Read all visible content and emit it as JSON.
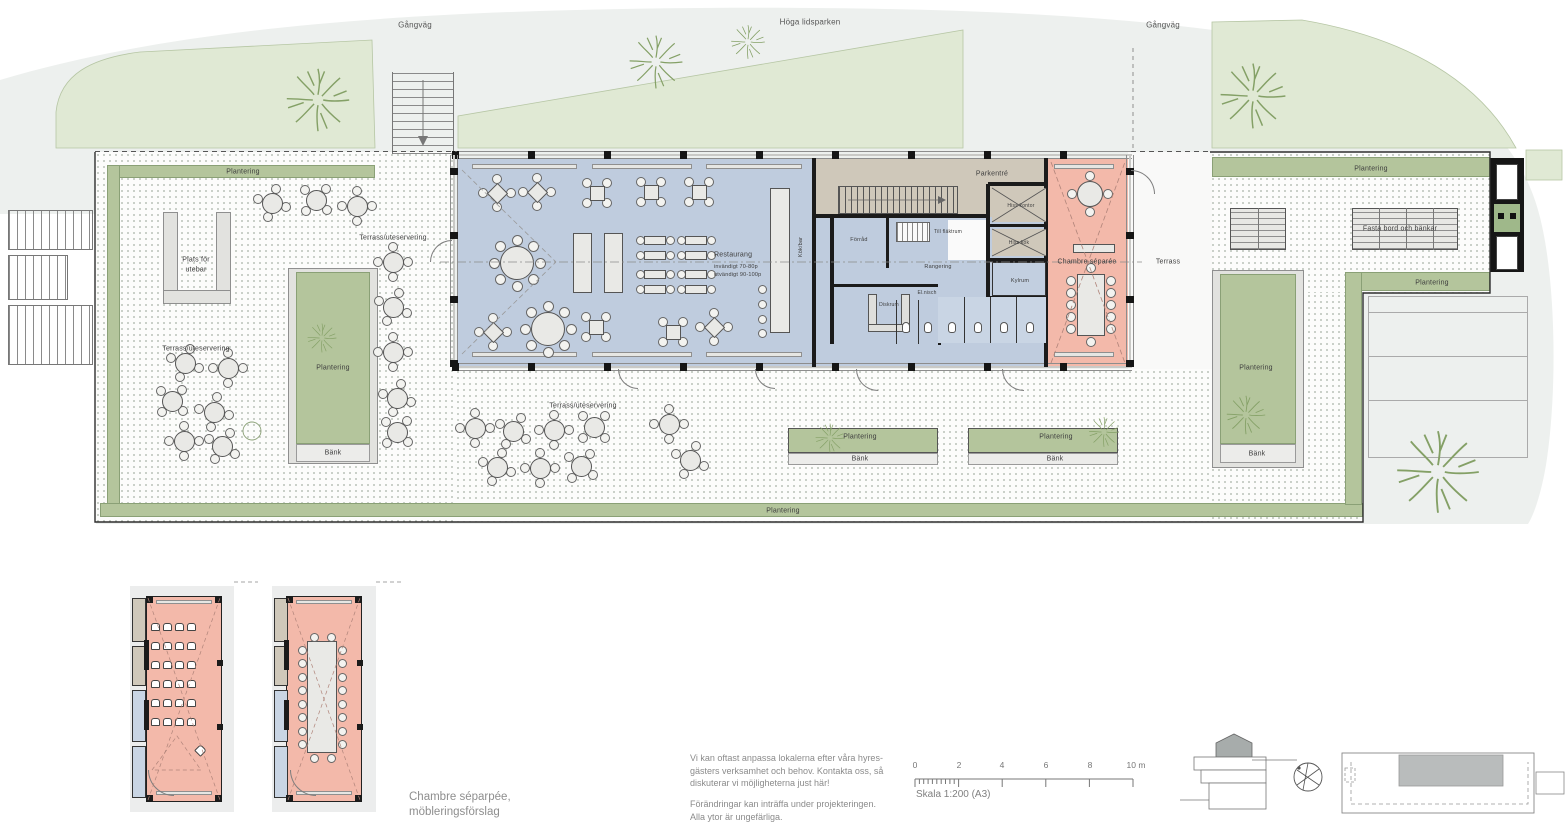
{
  "colors": {
    "park_green": "#e0e9d4",
    "walkway_gray": "#edf0ee",
    "planting_green": "#b4c59c",
    "building_blue": "#bfccde",
    "entrance_tan": "#cfc8ba",
    "separee_pink": "#f3b9aa",
    "furniture_gray": "#e9e9e6",
    "wall_black": "#1b1b1b"
  },
  "labels": {
    "gangvag": "Gångväg",
    "park_name": "Höga lidsparken",
    "plantering": "Plantering",
    "bank": "Bänk",
    "plats_for_utebar_1": "Plats för",
    "plats_for_utebar_2": "utebar",
    "terrass_uteservering": "Terrass/uteservering",
    "terrass": "Terrass",
    "fasta_bord": "Fasta bord och bänkar"
  },
  "building": {
    "restaurang": "Restaurang",
    "capacity_1": "invändigt 70-80p",
    "capacity_2": "utvändigt 90-100p",
    "kok_bar": "Kök/bar",
    "parkentre": "Parkentré",
    "forrad": "Förråd",
    "till_flaktrum": "Till fläktrum",
    "rangering": "Rangering",
    "diskrum": "Diskrum",
    "el_nisch": "El.nisch",
    "kylrum": "Kylrum",
    "hiss_kontor": "Hiss kontor",
    "hiss_kok": "Hiss kök",
    "chambre_separee": "Chambre séparée"
  },
  "details": {
    "caption_1": "Chambre séparpée,",
    "caption_2": "möbleringsförslag"
  },
  "footer": {
    "note1_1": "Vi kan oftast anpassa lokalerna efter våra hyres-",
    "note1_2": "gästers verksamhet och behov. Kontakta oss, så",
    "note1_3": "diskuterar vi möjligheterna just här!",
    "note2_1": "Förändringar kan inträffa under projekteringen.",
    "note2_2": "Alla ytor är ungefärliga.",
    "scale_caption": "Skala 1:200 (A3)",
    "scale_ticks": [
      "0",
      "2",
      "4",
      "6",
      "8",
      "10 m"
    ]
  }
}
